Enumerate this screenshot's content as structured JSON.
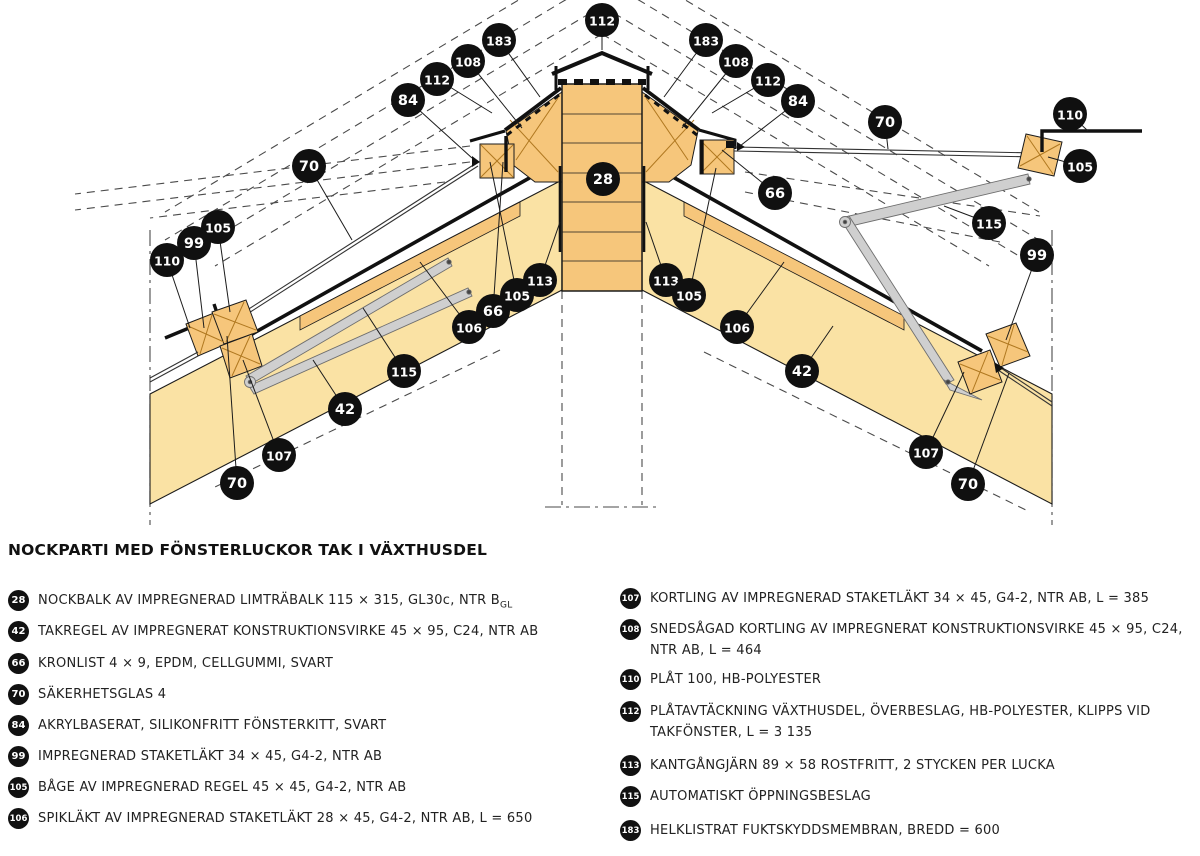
{
  "title": "NOCKPARTI MED FÖNSTERLUCKOR TAK I VÄXTHUSDEL",
  "legend": {
    "left": [
      {
        "num": "28",
        "text": "NOCKBALK AV IMPREGNERAD LIMTRÄBALK 115 × 315, GL30c, NTR B",
        "sub": "GL"
      },
      {
        "num": "42",
        "text": "TAKREGEL AV IMPREGNERAT KONSTRUKTIONSVIRKE 45 × 95, C24, NTR AB"
      },
      {
        "num": "66",
        "text": "KRONLIST 4 × 9, EPDM, CELLGUMMI, SVART"
      },
      {
        "num": "70",
        "text": "SÄKERHETSGLAS 4"
      },
      {
        "num": "84",
        "text": "AKRYLBASERAT, SILIKONFRITT FÖNSTERKITT, SVART"
      },
      {
        "num": "99",
        "text": "IMPREGNERAD STAKETLÄKT 34 × 45, G4-2, NTR AB"
      },
      {
        "num": "105",
        "text": "BÅGE AV IMPREGNERAD REGEL 45 × 45, G4-2, NTR AB"
      },
      {
        "num": "106",
        "text": "SPIKLÄKT AV IMPREGNERAD STAKETLÄKT 28 × 45, G4-2, NTR AB, L = 650"
      }
    ],
    "right": [
      {
        "num": "107",
        "text": "KORTLING AV IMPREGNERAD STAKETLÄKT 34 × 45, G4-2, NTR AB, L = 385"
      },
      {
        "num": "108",
        "text": "SNEDSÅGAD KORTLING AV IMPREGNERAT KONSTRUKTIONSVIRKE 45 × 95, C24, NTR AB, L = 464"
      },
      {
        "num": "110",
        "text": "PLÅT 100, HB-POLYESTER"
      },
      {
        "num": "112",
        "text": "PLÅTAVTÄCKNING VÄXTHUSDEL, ÖVERBESLAG, HB-POLYESTER, KLIPPS VID TAKFÖNSTER, L = 3 135"
      },
      {
        "num": "113",
        "text": "KANTGÅNGJÄRN 89 × 58 ROSTFRITT, 2 STYCKEN PER LUCKA"
      },
      {
        "num": "115",
        "text": "AUTOMATISKT ÖPPNINGSBESLAG"
      },
      {
        "num": "183",
        "text": "HELKLISTRAT FUKTSKYDDSMEMBRAN, BREDD = 600"
      }
    ]
  },
  "diagram": {
    "colors": {
      "wood": "#F6C67B",
      "pale": "#FAE2A4",
      "metal": "#CFCFCF",
      "line": "#1b1b1b",
      "dash": "#4a4a4a"
    },
    "callouts": [
      {
        "n": "112",
        "x": 602,
        "y": 20,
        "tx": 602,
        "ty": 50
      },
      {
        "n": "183",
        "x": 499,
        "y": 40,
        "tx": 540,
        "ty": 97
      },
      {
        "n": "108",
        "x": 468,
        "y": 61,
        "tx": 522,
        "ty": 128
      },
      {
        "n": "112",
        "x": 437,
        "y": 79,
        "tx": 492,
        "ty": 113
      },
      {
        "n": "84",
        "x": 408,
        "y": 100,
        "tx": 472,
        "ty": 158
      },
      {
        "n": "70",
        "x": 309,
        "y": 166,
        "tx": 352,
        "ty": 240
      },
      {
        "n": "105",
        "x": 218,
        "y": 227,
        "tx": 230,
        "ty": 312
      },
      {
        "n": "99",
        "x": 194,
        "y": 243,
        "tx": 204,
        "ty": 328
      },
      {
        "n": "110",
        "x": 167,
        "y": 260,
        "tx": 190,
        "ty": 328
      },
      {
        "n": "66",
        "x": 493,
        "y": 311,
        "tx": 503,
        "ty": 162
      },
      {
        "n": "105",
        "x": 517,
        "y": 295,
        "tx": 490,
        "ty": 162
      },
      {
        "n": "113",
        "x": 540,
        "y": 280,
        "tx": 560,
        "ty": 222
      },
      {
        "n": "28",
        "x": 603,
        "y": 179
      },
      {
        "n": "106",
        "x": 469,
        "y": 327,
        "tx": 420,
        "ty": 262
      },
      {
        "n": "115",
        "x": 404,
        "y": 371,
        "tx": 363,
        "ty": 308
      },
      {
        "n": "42",
        "x": 345,
        "y": 409,
        "tx": 313,
        "ty": 360
      },
      {
        "n": "107",
        "x": 279,
        "y": 455,
        "tx": 243,
        "ty": 360
      },
      {
        "n": "70",
        "x": 237,
        "y": 483,
        "tx": 227,
        "ty": 336
      },
      {
        "n": "183",
        "x": 706,
        "y": 40,
        "tx": 664,
        "ty": 97
      },
      {
        "n": "108",
        "x": 736,
        "y": 61,
        "tx": 682,
        "ty": 128
      },
      {
        "n": "112",
        "x": 768,
        "y": 80,
        "tx": 712,
        "ty": 113
      },
      {
        "n": "84",
        "x": 798,
        "y": 101,
        "tx": 740,
        "ty": 146
      },
      {
        "n": "70",
        "x": 885,
        "y": 122,
        "tx": 888,
        "ty": 149
      },
      {
        "n": "110",
        "x": 1070,
        "y": 114,
        "tx": 1088,
        "ty": 131
      },
      {
        "n": "105",
        "x": 1080,
        "y": 166,
        "tx": 1048,
        "ty": 157
      },
      {
        "n": "66",
        "x": 775,
        "y": 193,
        "tx": 722,
        "ty": 150
      },
      {
        "n": "113",
        "x": 666,
        "y": 280,
        "tx": 646,
        "ty": 222
      },
      {
        "n": "105",
        "x": 689,
        "y": 295,
        "tx": 716,
        "ty": 168
      },
      {
        "n": "115",
        "x": 989,
        "y": 223,
        "tx": 944,
        "ty": 206
      },
      {
        "n": "99",
        "x": 1037,
        "y": 255,
        "tx": 1006,
        "ty": 340
      },
      {
        "n": "106",
        "x": 737,
        "y": 327,
        "tx": 784,
        "ty": 262
      },
      {
        "n": "42",
        "x": 802,
        "y": 371,
        "tx": 833,
        "ty": 326
      },
      {
        "n": "107",
        "x": 926,
        "y": 452,
        "tx": 964,
        "ty": 372
      },
      {
        "n": "70",
        "x": 968,
        "y": 484,
        "tx": 1009,
        "ty": 373
      }
    ]
  }
}
